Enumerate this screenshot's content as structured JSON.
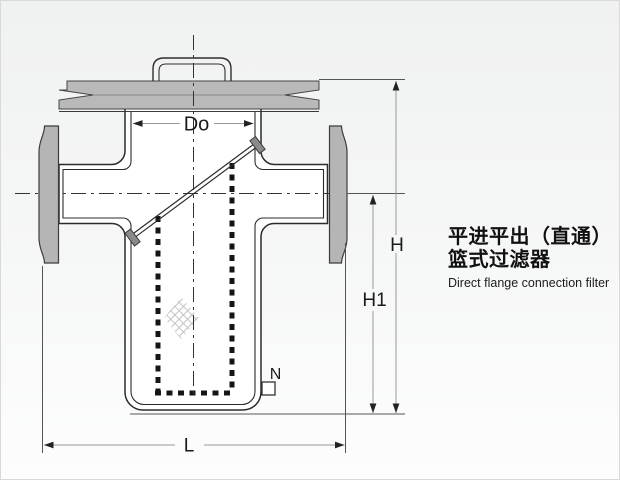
{
  "title_block": {
    "line1": "平进平出（直通）",
    "line2": "篮式过滤器",
    "subtitle": "Direct flange connection filter"
  },
  "dims": {
    "do": "Do",
    "h": "H",
    "h1": "H1",
    "l": "L",
    "n": "N"
  },
  "colors": {
    "background_top": "#f0f1f1",
    "background_bottom": "#fdfdfd",
    "outline": "#2b2b2b",
    "metal_gray": "#b5b5b5",
    "clip_gray": "#8a8a8a",
    "dimension_line": "#999999",
    "extension_line": "#555555",
    "centerline": "#333333",
    "basket_dash": "#151515",
    "page_border": "#d9d9d9"
  }
}
